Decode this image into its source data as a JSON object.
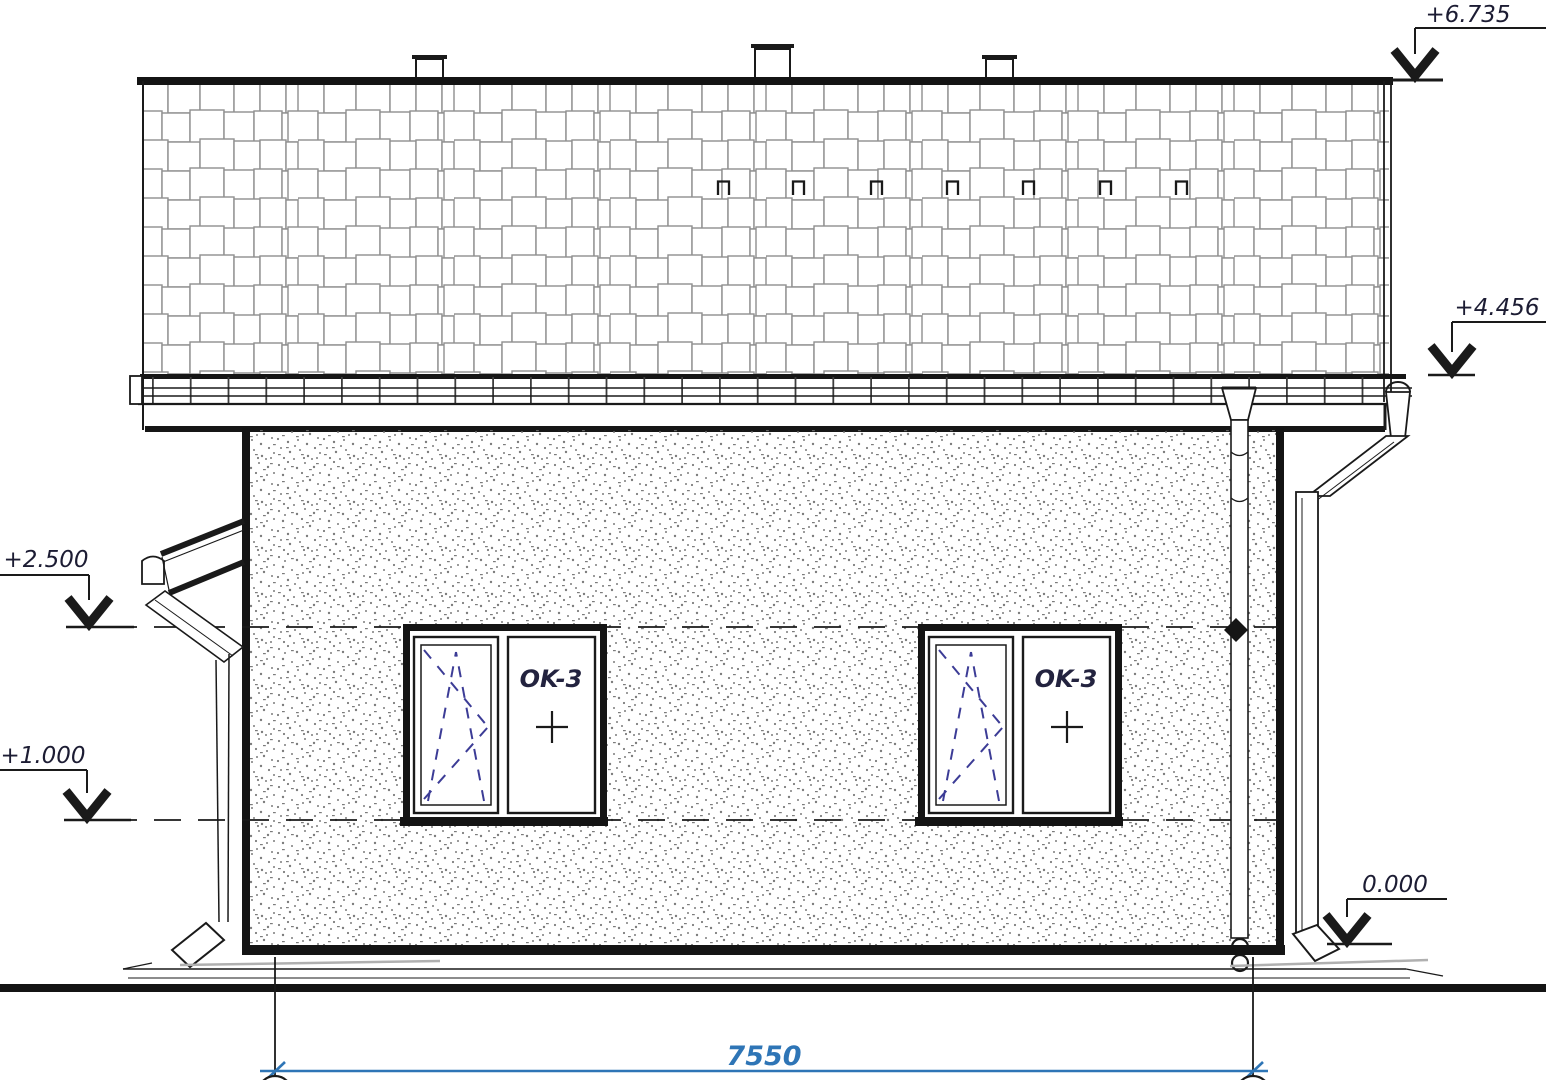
{
  "colors": {
    "line": "#1a1a1a",
    "dimension_blue": "#2e75b6",
    "window_symbol_blue": "#3c3c96",
    "label_navy": "#23233f"
  },
  "icons": {
    "level_arrow_icon": "v-chevron",
    "snow_guard_icon": "П-bracket",
    "fixed_pane_mark_icon": "+"
  },
  "elevation_marks": [
    {
      "id": "ridge",
      "label": "+6.735"
    },
    {
      "id": "eave",
      "label": "+4.456"
    },
    {
      "id": "lintel-level",
      "label": "+2.500"
    },
    {
      "id": "sill-level",
      "label": "+1.000"
    },
    {
      "id": "ground-level",
      "label": "0.000"
    }
  ],
  "windows": [
    {
      "tag": "OK-3"
    },
    {
      "tag": "OK-3"
    }
  ],
  "dimension": {
    "overall_width": "7550"
  }
}
